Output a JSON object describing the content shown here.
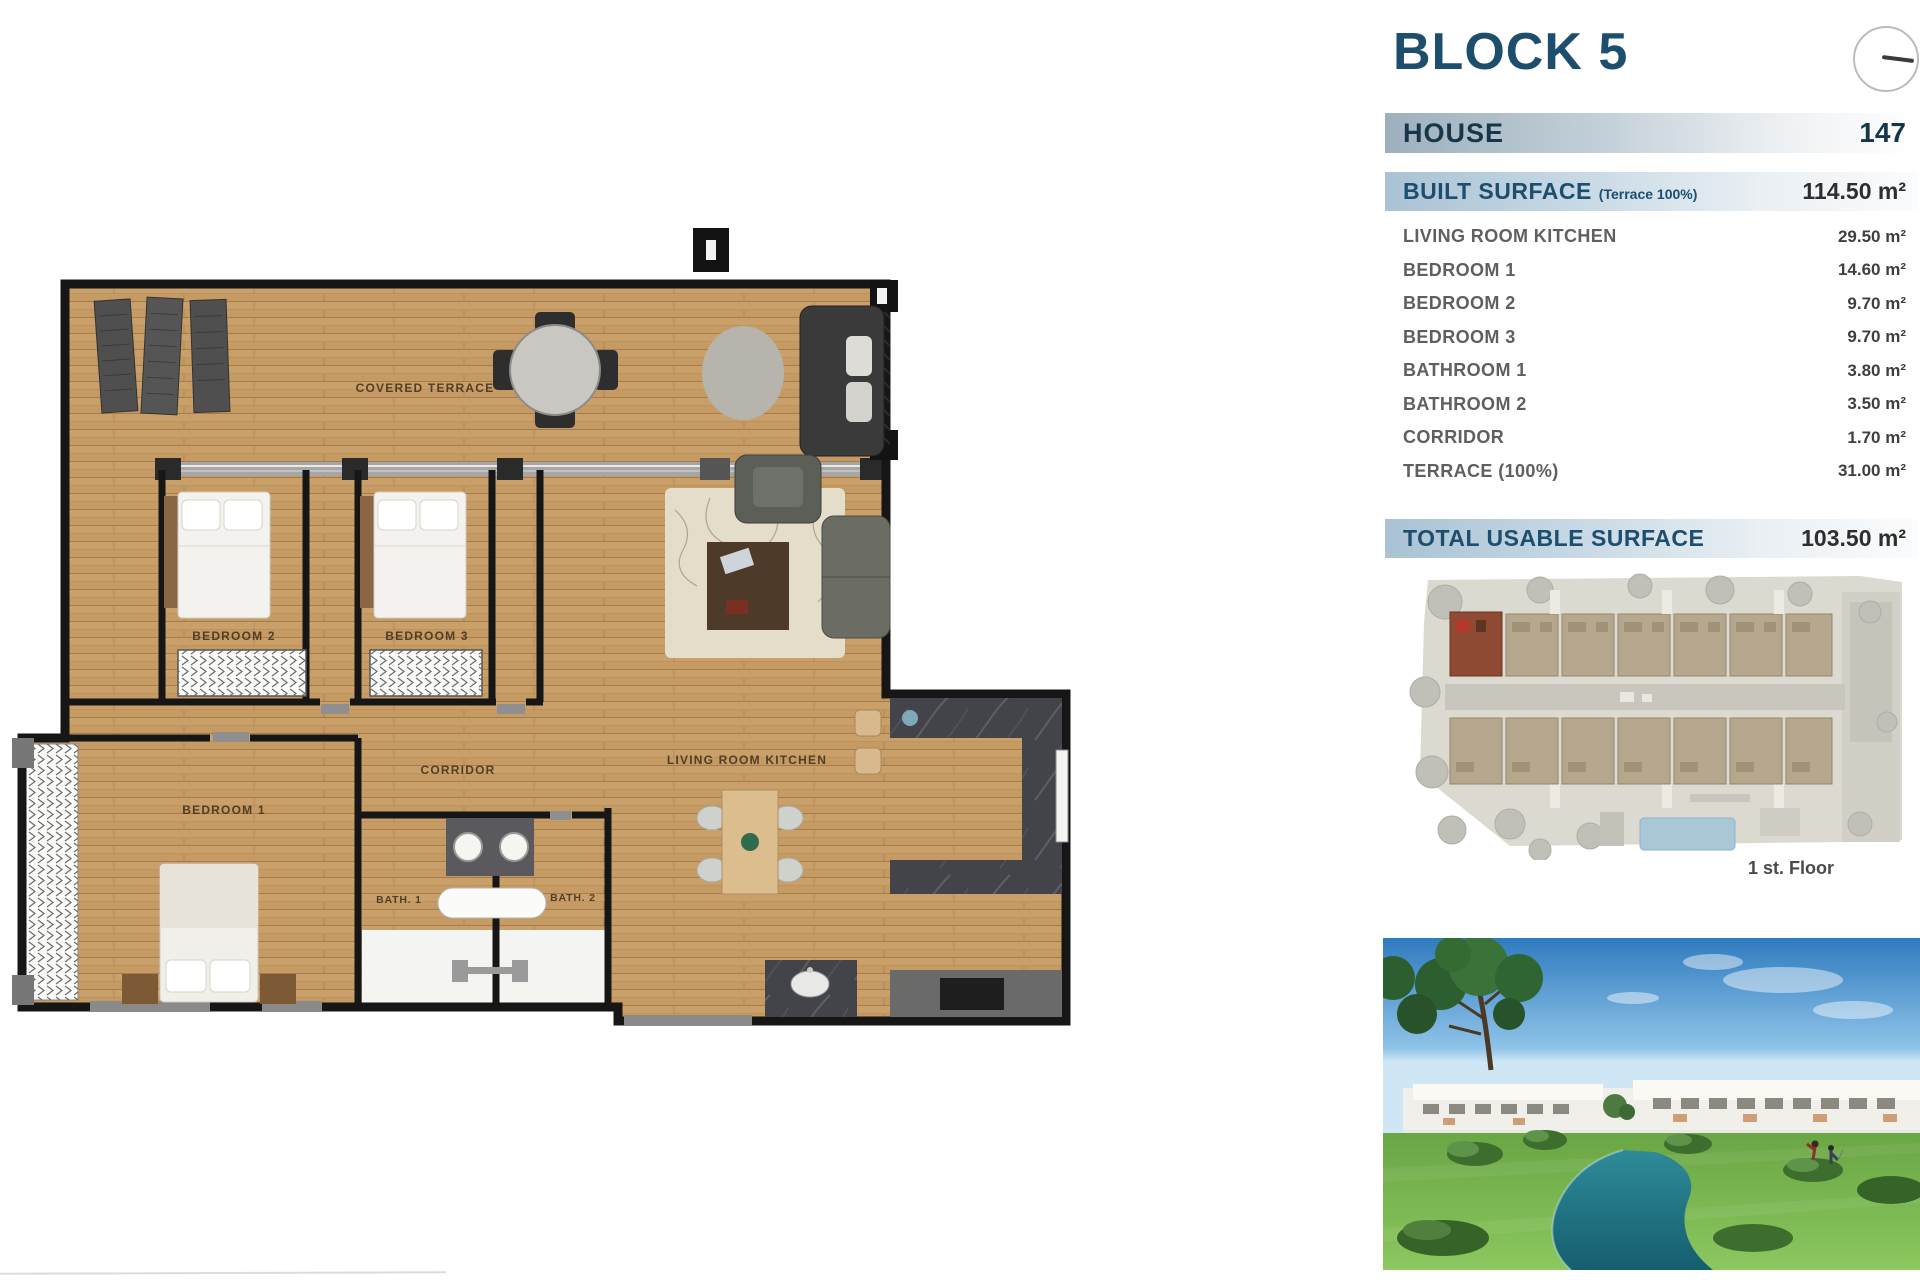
{
  "header": {
    "block_title": "BLOCK 5"
  },
  "table": {
    "house_label": "HOUSE",
    "house_value": "147",
    "built_label": "BUILT SURFACE",
    "built_note": "(Terrace 100%)",
    "built_value": "114.50 m²",
    "rows": [
      {
        "label": "LIVING ROOM KITCHEN",
        "value": "29.50 m²"
      },
      {
        "label": "BEDROOM 1",
        "value": "14.60 m²"
      },
      {
        "label": "BEDROOM 2",
        "value": "9.70 m²"
      },
      {
        "label": "BEDROOM 3",
        "value": "9.70 m²"
      },
      {
        "label": "BATHROOM 1",
        "value": "3.80 m²"
      },
      {
        "label": "BATHROOM 2",
        "value": "3.50 m²"
      },
      {
        "label": "CORRIDOR",
        "value": "1.70 m²"
      },
      {
        "label": "TERRACE (100%)",
        "value": "31.00 m²"
      }
    ],
    "total_label": "TOTAL USABLE SURFACE",
    "total_value": "103.50 m²"
  },
  "site_plan": {
    "floor_label": "1 st. Floor"
  },
  "plan": {
    "labels": {
      "covered_terrace": "COVERED TERRACE",
      "bedroom1": "BEDROOM 1",
      "bedroom2": "BEDROOM 2",
      "bedroom3": "BEDROOM 3",
      "corridor": "CORRIDOR",
      "living": "LIVING ROOM KITCHEN",
      "bath1": "BATH. 1",
      "bath2": "BATH. 2"
    }
  },
  "icons": {
    "compass": "circle-with-needle"
  },
  "colors": {
    "accent_navy": "#1d4e6e",
    "bar_blue": "#a9c2d4",
    "wood": "#c59a63",
    "wall": "#161616",
    "highlight_unit": "#8f4a33",
    "pool": "#aac7d8"
  }
}
